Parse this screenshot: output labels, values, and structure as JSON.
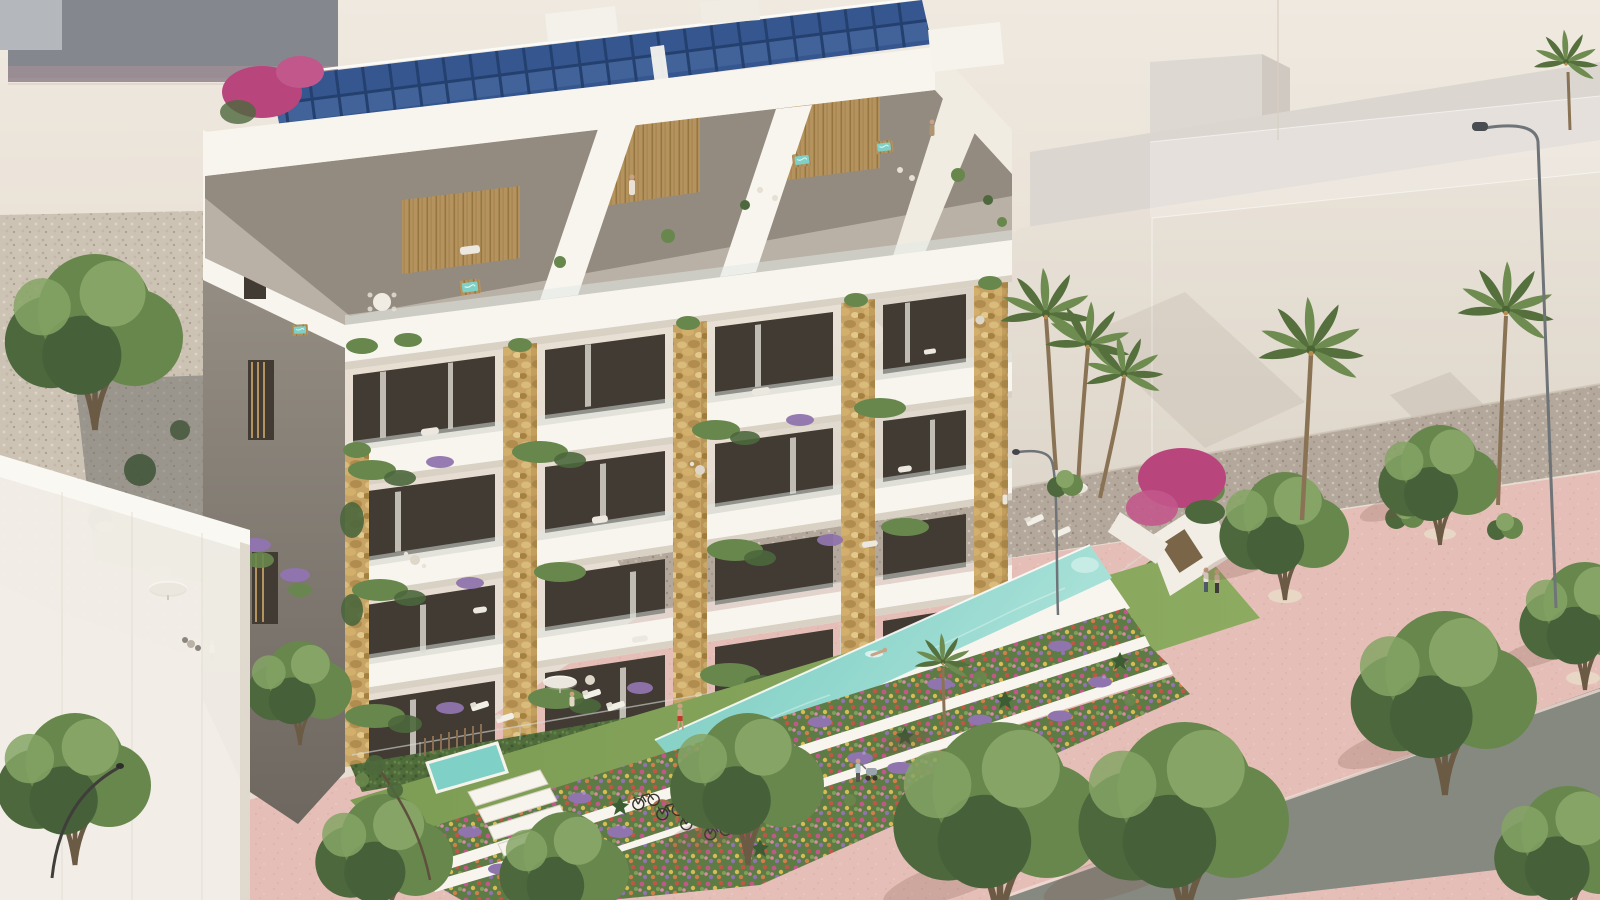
{
  "scene": {
    "type": "architectural-3d-render",
    "view": "elevated aerial view, warm daylight",
    "description": "Modern white apartment building with rooftop solar panels and penthouse terraces, stone-clad balcony piers with cascading plants, a raised turquoise lap pool over terraced flower beds, and a pink pedestrian promenade lined with trees and palm trees.",
    "building": {
      "floors_visible": 6,
      "penthouse_terraces": 3,
      "rooftop_solar_array": {
        "panel_modules_visible": 22
      },
      "stone_clad_piers": 5,
      "hot_tubs_visible": 4,
      "balcony_plants": "hanging greenery and lavender window boxes",
      "end_wall": "grey stucco with wood-louvre windows"
    },
    "amenities": {
      "lap_pool": {
        "swimmers": 1,
        "style": "raised infinity edge"
      },
      "plunge_pool": 1,
      "sun_loungers": 6,
      "parasols": 3,
      "flower_bed_terraces": 4,
      "bike_rack_bicycles": 4
    },
    "people": [
      {
        "location": "penthouse terrace left",
        "activity": "standing"
      },
      {
        "location": "penthouse terrace right",
        "activity": "sitting"
      },
      {
        "location": "pool lawn",
        "activity": "walking in red swim shorts"
      },
      {
        "location": "lap pool",
        "activity": "swimming"
      },
      {
        "location": "pool deck end",
        "activity": "standing"
      },
      {
        "location": "private garden loungers",
        "activity": "standing"
      },
      {
        "location": "upper-left path",
        "activity": "walking"
      },
      {
        "location": "promenade",
        "activity": "pushing a stroller"
      },
      {
        "location": "promenade right",
        "activity": "couple walking"
      }
    ],
    "vegetation": {
      "palm_trees": 7,
      "deciduous_trees": 12,
      "shrubs_on_revetment": 4,
      "bougainvillea_clusters": 2,
      "lavender_clumps": "throughout flower terraces and balconies"
    },
    "streetscape": {
      "promenade": "rose pink paving with circular tree pits",
      "road": "grey asphalt strip crossing lower right",
      "street_lamps": 3,
      "gravel_revetment": "speckled stone slope below upper wall",
      "neighbor_buildings": "pale beige massing, one translucent ghost volume, grey slab block upper left"
    }
  },
  "palette": {
    "sky_top": "#efe9e0",
    "sky_warm": "#e6dccf",
    "neighbor_gray": "#84878d",
    "neighbor_gray_light": "#b4b7bb",
    "neighbor_mauve": "#9a8c93",
    "ghost_white": "#f4f1ec",
    "slab_light": "#dbd6d0",
    "wall_pale": "#e3dcd2",
    "gravel_band": "#b3a89b",
    "slope_gravel": "#cdc3b5",
    "promenade_pink": "#e5bfb7",
    "promenade_shadow": "#7a5048",
    "road_gray": "#85897f",
    "building_white": "#f8f5ef",
    "building_white_warm": "#f1ece2",
    "slab_shade": "#d8d1c4",
    "recess_tan": "#b9b1a6",
    "recess_shadow": "#8a8177",
    "endwall_gray": "#948d83",
    "endwall_dark": "#6e6760",
    "glazing_dark": "#413b33",
    "curtain_light": "#d7d4cb",
    "stone_tan": "#c7a365",
    "stone_dark": "#a5813f",
    "stone_light": "#d9bc7c",
    "wood_slat": "#b5935f",
    "wood_dark": "#97763f",
    "glass_balustrade": "#dfe7e4",
    "solar_navy": "#24406e",
    "solar_blue": "#35568f",
    "pool_light": "#aee3da",
    "pool_deep": "#5fb9b0",
    "lawn_green": "#8cab60",
    "lawn_deep": "#75954e",
    "hedge_green": "#4f6c3a",
    "leaf_dark": "#4c683c",
    "leaf_mid": "#68874d",
    "leaf_light": "#85a465",
    "palm_dark": "#55703d",
    "palm_mid": "#6e8c50",
    "trunk_brown": "#8a7355",
    "flower_magenta": "#b8457c",
    "flower_pink": "#c2578c",
    "lavender": "#8f74ad",
    "lavender_light": "#a98fc4",
    "flower_red": "#c05746",
    "flower_orange": "#cf7f4a",
    "flower_yellow": "#d9bb55",
    "skin": "#c9a183",
    "lamp_gray": "#6f7478",
    "rack_rust": "#a4704c"
  }
}
